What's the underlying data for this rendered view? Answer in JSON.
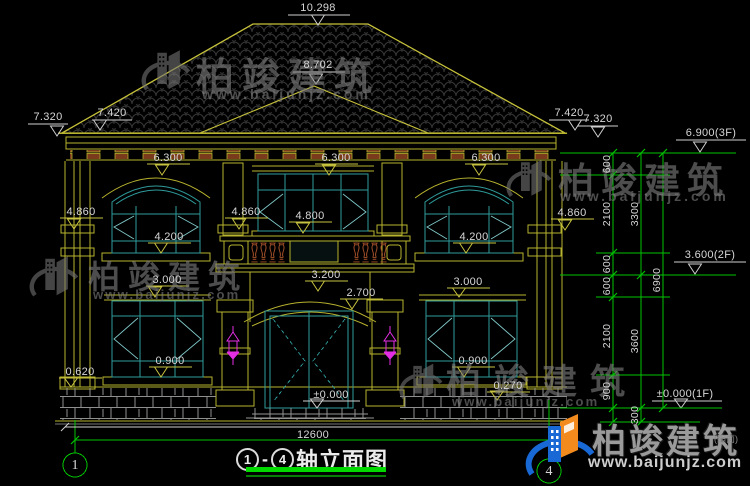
{
  "watermark": {
    "brand": "柏竣建筑",
    "site": "www.baijunjz.com",
    "suffix": "(缩面)"
  },
  "logo": {
    "brand": "柏竣建筑",
    "site": "www.baijunjz.com"
  },
  "title": {
    "axis_from": "1",
    "sep": "-",
    "axis_to": "4",
    "text": "轴立面图"
  },
  "axis": {
    "left": "1",
    "right": "4"
  },
  "dims": {
    "d10298": "10.298",
    "d8702": "8.702",
    "l7320": "7.320",
    "l7420": "7.420",
    "r7420": "7.420",
    "r7320": "7.320",
    "e6300a": "6.300",
    "e6300b": "6.300",
    "e6300c": "6.300",
    "e4860a": "4.860",
    "e4860b": "4.860",
    "e4860c": "4.860",
    "e4800": "4.800",
    "e4200a": "4.200",
    "e4200b": "4.200",
    "e3200": "3.200",
    "e2700": "2.700",
    "e3000a": "3.000",
    "e3000b": "3.000",
    "e0900a": "0.900",
    "e0900b": "0.900",
    "e0620": "0.620",
    "e0270": "0.270",
    "e0000": "±0.000",
    "lv3f": "6.900(3F)",
    "lv2f": "3.600(2F)",
    "lv1f": "±0.000(1F)",
    "w12600": "12600",
    "g600a": "600",
    "g2100a": "2100",
    "g600b": "600",
    "g600c": "600",
    "g2100b": "2100",
    "g900": "900",
    "g300": "300",
    "g3300": "3300",
    "g3600": "3600",
    "g6900": "6900"
  }
}
